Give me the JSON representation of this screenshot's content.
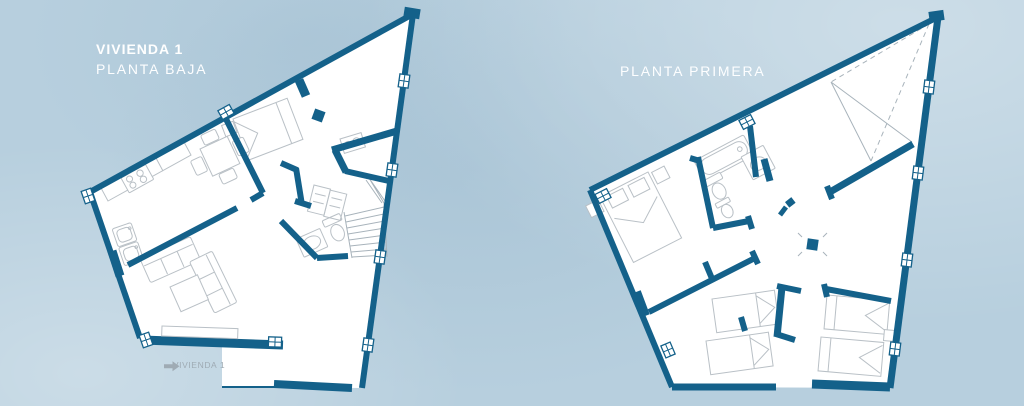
{
  "page": {
    "width": 1024,
    "height": 406,
    "background": "#b7cfde"
  },
  "colors": {
    "wall": "#14618a",
    "floor": "#ffffff",
    "furniture_line": "#b9c0c6",
    "detail_line": "#a8b3bb",
    "label_gray": "#9fabb4",
    "title_white": "#ffffff"
  },
  "plans": {
    "planta_baja": {
      "title": "VIVIENDA 1",
      "subtitle": "PLANTA BAJA",
      "entry_label": "VIVIENDA 1"
    },
    "planta_primera": {
      "title": "PLANTA PRIMERA"
    }
  }
}
